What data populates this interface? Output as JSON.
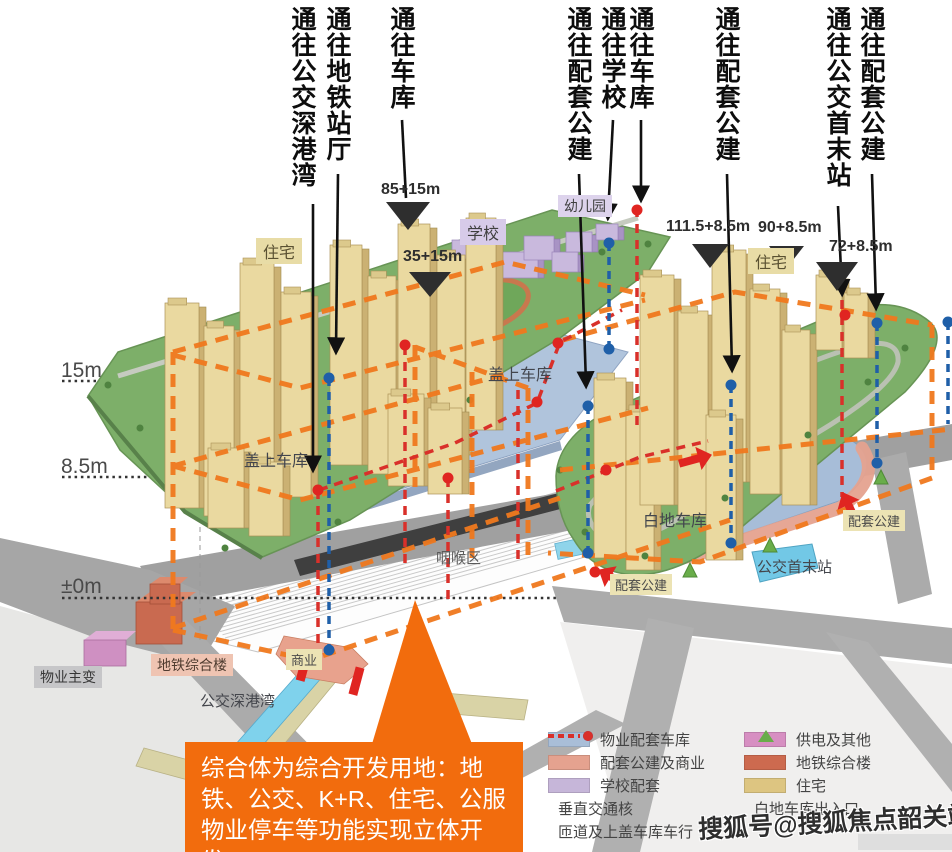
{
  "top_labels": [
    {
      "text": "通往公交深港湾"
    },
    {
      "text": "通往地铁站厅"
    },
    {
      "text": "通往车库"
    },
    {
      "text": "通往配套公建"
    },
    {
      "text": "通往学校"
    },
    {
      "text": "通往车库"
    },
    {
      "text": "通往配套公建"
    },
    {
      "text": "通往公交首末站"
    },
    {
      "text": "通往配套公建"
    }
  ],
  "measurements": [
    {
      "text": "85+15m"
    },
    {
      "text": "35+15m"
    },
    {
      "text": "111.5+8.5m"
    },
    {
      "text": "90+8.5m"
    },
    {
      "text": "72+8.5m"
    }
  ],
  "levels": [
    {
      "text": "15m"
    },
    {
      "text": "8.5m"
    },
    {
      "text": "±0m"
    }
  ],
  "areas": {
    "zhuzhai_left": "住宅",
    "xuexiao": "学校",
    "youeryuan": "幼儿园",
    "zhuzhai_right": "住宅",
    "gaishang_left": "盖上车库",
    "gaishang_right": "盖上车库",
    "baidi": "白地车库",
    "yanhou": "咽喉区",
    "peitao_right": "配套公建",
    "peitao_bottom": "配套公建",
    "gongjiao_shoumo": "公交首末站",
    "wuye": "物业主变",
    "ditie": "地铁综合楼",
    "shangye": "商业",
    "gongjiao_shengang": "公交深港湾"
  },
  "callout": {
    "text": "综合体为综合开发用地：地铁、公交、K+R、住宅、公服物业停车等功能实现立体开发。"
  },
  "legend": {
    "left": [
      {
        "type": "swatch",
        "color": "#a9bed8",
        "label": "物业配套车库"
      },
      {
        "type": "swatch",
        "color": "#e5a28f",
        "label": "配套公建及商业"
      },
      {
        "type": "swatch",
        "color": "#c6b6d9",
        "label": "学校配套"
      },
      {
        "type": "dash",
        "color": "#1f5fa8",
        "label": "垂直交通核"
      },
      {
        "type": "dash",
        "color": "#d9302a",
        "label": "匝道及上盖车库车行"
      }
    ],
    "right": [
      {
        "type": "swatch",
        "color": "#d78fc2",
        "label": "供电及其他"
      },
      {
        "type": "swatch",
        "color": "#cd6a4f",
        "label": "地铁综合楼"
      },
      {
        "type": "swatch",
        "color": "#ddc581",
        "label": "住宅"
      },
      {
        "type": "triangle",
        "color": "#69ad4a",
        "label": "白地车库出入口"
      }
    ]
  },
  "watermark": {
    "text": "搜狐号@搜狐焦点韶关站"
  },
  "colors": {
    "wireframe": "#f0791e",
    "callout_bg": "#f26c0d",
    "deck": "#aec3dc",
    "platform_green": "#7daf69",
    "vertical_core": "#1f5fa8",
    "ramp_route": "#d9302a",
    "ground_garage": "#a7bdd8"
  }
}
